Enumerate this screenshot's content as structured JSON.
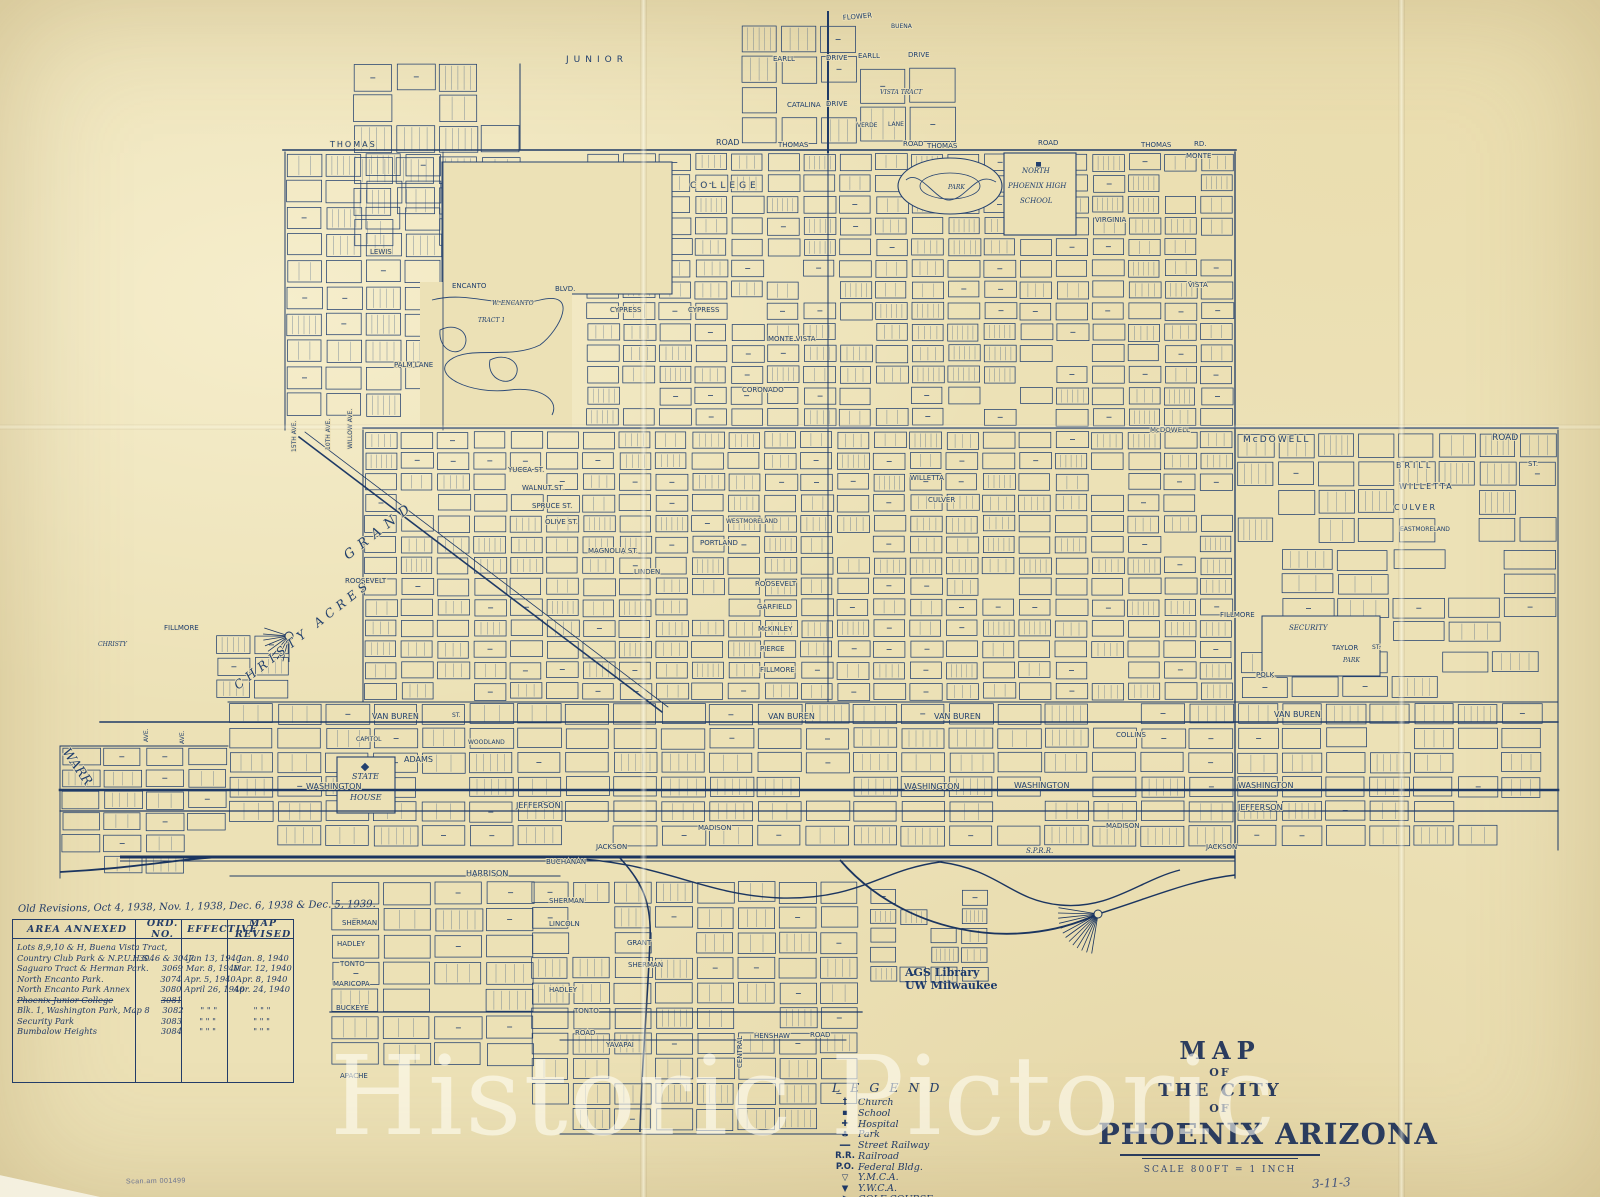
{
  "colors": {
    "ink": "#24416f",
    "paper": "#ece1b6"
  },
  "watermark": "Historic Pictoric",
  "title_block": {
    "map": "MAP",
    "of1": "OF",
    "the_city": "THE CITY",
    "of2": "OF",
    "city": "PHOENIX ARIZONA",
    "scale": "SCALE  800FT = 1 INCH"
  },
  "stamp": {
    "line1": "AGS Library",
    "line2": "UW Milwaukee"
  },
  "annotations": {
    "corner_note": "3-11-3",
    "scan_note": "Scan.am 001499"
  },
  "legend": {
    "title": "L E G E N D",
    "items": [
      {
        "icon": "church-icon",
        "glyph": "†",
        "label": "Church"
      },
      {
        "icon": "school-icon",
        "glyph": "▪",
        "label": "School"
      },
      {
        "icon": "hospital-icon",
        "glyph": "✚",
        "label": "Hospital"
      },
      {
        "icon": "park-icon",
        "glyph": "♣",
        "label": "Park"
      },
      {
        "icon": "street-railway-icon",
        "glyph": "━━",
        "label": "Street Railway"
      },
      {
        "icon": "railroad-icon",
        "glyph": "R.R.",
        "label": "Railroad"
      },
      {
        "icon": "federal-bldg-icon",
        "glyph": "P.O.",
        "label": "Federal Bldg."
      },
      {
        "icon": "ymca-icon",
        "glyph": "▽",
        "label": "Y.M.C.A."
      },
      {
        "icon": "ywca-icon",
        "glyph": "▼",
        "label": "Y.W.C.A."
      },
      {
        "icon": "golf-course-icon",
        "glyph": "⚑",
        "label": "GOLF COURSE"
      }
    ]
  },
  "annex": {
    "note": "Old Revisions, Oct 4, 1938,  Nov. 1, 1938,  Dec. 6, 1938 & Dec. 5, 1939.",
    "headers": [
      "AREA  ANNEXED",
      "ORD. NO.",
      "EFFECTIVE",
      "MAP REVISED"
    ],
    "rows": [
      {
        "area": "Lots 8,9,10 & H, Buena Vista Tract,",
        "ord": "",
        "eff": "",
        "rev": "",
        "struck": false
      },
      {
        "area": "Country Club Park & N.P.U.H.S.",
        "ord": "3046 & 3047",
        "eff": "Jan 13, 1940",
        "rev": "Jan. 8, 1940",
        "struck": false
      },
      {
        "area": "Saguaro Tract & Herman Park.",
        "ord": "3069",
        "eff": "Mar. 8, 1940",
        "rev": "Mar. 12, 1940",
        "struck": false
      },
      {
        "area": "North Encanto Park.",
        "ord": "3074",
        "eff": "Apr. 5, 1940",
        "rev": "Apr. 8, 1940",
        "struck": false
      },
      {
        "area": "North Encanto Park Annex",
        "ord": "3080",
        "eff": "April 26, 1940",
        "rev": "Apr. 24, 1940",
        "struck": false
      },
      {
        "area": "Phoenix Junior College",
        "ord": "3081",
        "eff": "",
        "rev": "",
        "struck": true
      },
      {
        "area": "Blk. 1, Washington Park, Map 8",
        "ord": "3082",
        "eff": "\"   \"   \"",
        "rev": "\"   \"   \"",
        "struck": false
      },
      {
        "area": "Security Park",
        "ord": "3083",
        "eff": "\"   \"   \"",
        "rev": "\"   \"   \"",
        "struck": false
      },
      {
        "area": "Bumbalow Heights",
        "ord": "3084",
        "eff": "\"   \"   \"",
        "rev": "\"   \"   \"",
        "struck": false
      }
    ]
  },
  "map": {
    "labels": [
      {
        "t": "JUNIOR",
        "x": 566,
        "y": 62,
        "s": 9,
        "ls": 5
      },
      {
        "t": "COLLEGE",
        "x": 690,
        "y": 188,
        "s": 9,
        "ls": 4
      },
      {
        "t": "THOMAS",
        "x": 330,
        "y": 147,
        "s": 8,
        "ls": 2
      },
      {
        "t": "ROAD",
        "x": 716,
        "y": 145,
        "s": 8
      },
      {
        "t": "THOMAS",
        "x": 778,
        "y": 147,
        "s": 7
      },
      {
        "t": "ROAD",
        "x": 903,
        "y": 146,
        "s": 7
      },
      {
        "t": "THOMAS",
        "x": 927,
        "y": 148,
        "s": 7
      },
      {
        "t": "ROAD",
        "x": 1038,
        "y": 145,
        "s": 7
      },
      {
        "t": "THOMAS",
        "x": 1141,
        "y": 147,
        "s": 7
      },
      {
        "t": "RD.",
        "x": 1194,
        "y": 146,
        "s": 7
      },
      {
        "t": "FLOWER",
        "x": 843,
        "y": 20,
        "s": 7,
        "r": -5
      },
      {
        "t": "BUENA",
        "x": 891,
        "y": 28,
        "s": 6
      },
      {
        "t": "VISTA TRACT",
        "x": 880,
        "y": 94,
        "s": 6,
        "i": 1
      },
      {
        "t": "EARLL",
        "x": 773,
        "y": 61,
        "s": 7
      },
      {
        "t": "DRIVE",
        "x": 826,
        "y": 60,
        "s": 7
      },
      {
        "t": "EARLL",
        "x": 858,
        "y": 58,
        "s": 7
      },
      {
        "t": "DRIVE",
        "x": 908,
        "y": 57,
        "s": 7
      },
      {
        "t": "CATALINA",
        "x": 787,
        "y": 107,
        "s": 7
      },
      {
        "t": "DRIVE",
        "x": 826,
        "y": 106,
        "s": 7
      },
      {
        "t": "VERDE",
        "x": 857,
        "y": 127,
        "s": 6
      },
      {
        "t": "LANE",
        "x": 888,
        "y": 126,
        "s": 6
      },
      {
        "t": "NORTH",
        "x": 1022,
        "y": 173,
        "s": 7,
        "i": 1
      },
      {
        "t": "PHOENIX HIGH",
        "x": 1008,
        "y": 188,
        "s": 7,
        "i": 1
      },
      {
        "t": "SCHOOL",
        "x": 1020,
        "y": 203,
        "s": 7,
        "i": 1
      },
      {
        "t": "PARK",
        "x": 948,
        "y": 189,
        "s": 6,
        "i": 1
      },
      {
        "t": "MONTE",
        "x": 1186,
        "y": 158,
        "s": 7
      },
      {
        "t": "VIRGINIA",
        "x": 1095,
        "y": 222,
        "s": 7
      },
      {
        "t": "VISTA",
        "x": 1188,
        "y": 287,
        "s": 7
      },
      {
        "t": "ENCANTO",
        "x": 452,
        "y": 288,
        "s": 7
      },
      {
        "t": "BLVD.",
        "x": 555,
        "y": 291,
        "s": 7
      },
      {
        "t": "W. ENCANTO",
        "x": 492,
        "y": 305,
        "s": 6,
        "i": 1
      },
      {
        "t": "TRACT 1",
        "x": 478,
        "y": 322,
        "s": 6,
        "i": 1
      },
      {
        "t": "CYPRESS",
        "x": 610,
        "y": 312,
        "s": 7
      },
      {
        "t": "CYPRESS",
        "x": 688,
        "y": 312,
        "s": 7
      },
      {
        "t": "MONTE VISTA",
        "x": 768,
        "y": 341,
        "s": 7
      },
      {
        "t": "PALM LANE",
        "x": 394,
        "y": 367,
        "s": 7
      },
      {
        "t": "CORONADO",
        "x": 742,
        "y": 392,
        "s": 7
      },
      {
        "t": "LEWIS",
        "x": 370,
        "y": 254,
        "s": 7
      },
      {
        "t": "McDOWELL",
        "x": 1243,
        "y": 442,
        "s": 9,
        "ls": 2
      },
      {
        "t": "ROAD",
        "x": 1492,
        "y": 440,
        "s": 9
      },
      {
        "t": "McDOWELL",
        "x": 1150,
        "y": 432,
        "s": 7
      },
      {
        "t": "BRILL",
        "x": 1396,
        "y": 468,
        "s": 8,
        "ls": 3
      },
      {
        "t": "ST.",
        "x": 1528,
        "y": 466,
        "s": 7
      },
      {
        "t": "WILLETTA",
        "x": 1399,
        "y": 489,
        "s": 8,
        "ls": 2
      },
      {
        "t": "CULVER",
        "x": 1394,
        "y": 510,
        "s": 8,
        "ls": 2
      },
      {
        "t": "EASTMORELAND",
        "x": 1400,
        "y": 531,
        "s": 6
      },
      {
        "t": "WILLETTA",
        "x": 910,
        "y": 480,
        "s": 7
      },
      {
        "t": "CULVER",
        "x": 928,
        "y": 502,
        "s": 7
      },
      {
        "t": "YUCCA ST.",
        "x": 508,
        "y": 472,
        "s": 7
      },
      {
        "t": "WALNUT ST.",
        "x": 522,
        "y": 490,
        "s": 7
      },
      {
        "t": "SPRUCE ST.",
        "x": 532,
        "y": 508,
        "s": 7
      },
      {
        "t": "OLIVE ST.",
        "x": 545,
        "y": 524,
        "s": 7
      },
      {
        "t": "MAGNOLIA ST.",
        "x": 588,
        "y": 553,
        "s": 7
      },
      {
        "t": "LINDEN",
        "x": 634,
        "y": 574,
        "s": 7
      },
      {
        "t": "PORTLAND",
        "x": 700,
        "y": 545,
        "s": 7
      },
      {
        "t": "WESTMORELAND",
        "x": 726,
        "y": 523,
        "s": 6
      },
      {
        "t": "ROOSEVELT",
        "x": 345,
        "y": 583,
        "s": 7
      },
      {
        "t": "ROOSEVELT",
        "x": 755,
        "y": 586,
        "s": 7
      },
      {
        "t": "GARFIELD",
        "x": 757,
        "y": 609,
        "s": 7
      },
      {
        "t": "McKINLEY",
        "x": 758,
        "y": 631,
        "s": 7
      },
      {
        "t": "PIERCE",
        "x": 760,
        "y": 651,
        "s": 7
      },
      {
        "t": "FILLMORE",
        "x": 760,
        "y": 672,
        "s": 7
      },
      {
        "t": "GRAND",
        "x": 348,
        "y": 560,
        "r": -38,
        "s": 13,
        "ls": 7,
        "i": 1
      },
      {
        "t": "CHRISTY  ACRES",
        "x": 238,
        "y": 690,
        "r": -38,
        "s": 12,
        "ls": 5,
        "i": 1
      },
      {
        "t": "CHRISTY",
        "x": 98,
        "y": 646,
        "s": 6,
        "i": 1
      },
      {
        "t": "FILLMORE",
        "x": 164,
        "y": 630,
        "s": 7
      },
      {
        "t": "FILLMORE",
        "x": 1220,
        "y": 617,
        "s": 7
      },
      {
        "t": "SECURITY",
        "x": 1289,
        "y": 630,
        "s": 7,
        "i": 1
      },
      {
        "t": "TAYLOR",
        "x": 1332,
        "y": 650,
        "s": 7
      },
      {
        "t": "ST.",
        "x": 1372,
        "y": 649,
        "s": 6
      },
      {
        "t": "PARK",
        "x": 1343,
        "y": 662,
        "s": 6,
        "i": 1
      },
      {
        "t": "POLK",
        "x": 1256,
        "y": 677,
        "s": 7
      },
      {
        "t": "VAN BUREN",
        "x": 372,
        "y": 719,
        "s": 8
      },
      {
        "t": "ST.",
        "x": 452,
        "y": 717,
        "s": 6
      },
      {
        "t": "VAN BUREN",
        "x": 768,
        "y": 719,
        "s": 8
      },
      {
        "t": "VAN BUREN",
        "x": 934,
        "y": 719,
        "s": 8
      },
      {
        "t": "VAN BUREN",
        "x": 1274,
        "y": 717,
        "s": 8
      },
      {
        "t": "COLLINS",
        "x": 1116,
        "y": 737,
        "s": 7
      },
      {
        "t": "WOODLAND",
        "x": 468,
        "y": 744,
        "s": 6
      },
      {
        "t": "CAPITOL",
        "x": 356,
        "y": 741,
        "s": 6
      },
      {
        "t": "ADAMS",
        "x": 404,
        "y": 762,
        "s": 8
      },
      {
        "t": "STATE",
        "x": 352,
        "y": 779,
        "s": 8,
        "i": 1
      },
      {
        "t": "HOUSE",
        "x": 350,
        "y": 800,
        "s": 8,
        "i": 1
      },
      {
        "t": "WASHINGTON",
        "x": 306,
        "y": 789,
        "s": 8
      },
      {
        "t": "WASHINGTON",
        "x": 904,
        "y": 789,
        "s": 8
      },
      {
        "t": "WASHINGTON",
        "x": 1014,
        "y": 788,
        "s": 8
      },
      {
        "t": "WASHINGTON",
        "x": 1238,
        "y": 788,
        "s": 8
      },
      {
        "t": "JEFFERSON",
        "x": 516,
        "y": 808,
        "s": 8
      },
      {
        "t": "JEFFERSON",
        "x": 1238,
        "y": 810,
        "s": 8
      },
      {
        "t": "MADISON",
        "x": 698,
        "y": 830,
        "s": 7
      },
      {
        "t": "MADISON",
        "x": 1106,
        "y": 828,
        "s": 7
      },
      {
        "t": "JACKSON",
        "x": 596,
        "y": 849,
        "s": 7
      },
      {
        "t": "JACKSON",
        "x": 1206,
        "y": 849,
        "s": 7
      },
      {
        "t": "HARRISON",
        "x": 466,
        "y": 876,
        "s": 8
      },
      {
        "t": "S.P.R.R.",
        "x": 1026,
        "y": 853,
        "s": 7,
        "i": 1
      },
      {
        "t": "BUCHANAN",
        "x": 546,
        "y": 864,
        "s": 7
      },
      {
        "t": "SHERMAN",
        "x": 549,
        "y": 903,
        "s": 7
      },
      {
        "t": "LINCOLN",
        "x": 549,
        "y": 926,
        "s": 7
      },
      {
        "t": "GRANT",
        "x": 627,
        "y": 945,
        "s": 7
      },
      {
        "t": "SHERMAN",
        "x": 628,
        "y": 967,
        "s": 7
      },
      {
        "t": "HADLEY",
        "x": 549,
        "y": 992,
        "s": 7
      },
      {
        "t": "TONTO",
        "x": 574,
        "y": 1013,
        "s": 7
      },
      {
        "t": "SHERMAN",
        "x": 342,
        "y": 925,
        "s": 7
      },
      {
        "t": "HADLEY",
        "x": 337,
        "y": 946,
        "s": 7
      },
      {
        "t": "TONTO",
        "x": 340,
        "y": 966,
        "s": 7
      },
      {
        "t": "MARICOPA",
        "x": 333,
        "y": 986,
        "s": 7
      },
      {
        "t": "BUCKEYE",
        "x": 336,
        "y": 1010,
        "s": 7
      },
      {
        "t": "APACHE",
        "x": 340,
        "y": 1078,
        "s": 7
      },
      {
        "t": "ROAD",
        "x": 575,
        "y": 1035,
        "s": 7
      },
      {
        "t": "HENSHAW",
        "x": 754,
        "y": 1038,
        "s": 7
      },
      {
        "t": "ROAD",
        "x": 810,
        "y": 1037,
        "s": 7
      },
      {
        "t": "YAVAPAI",
        "x": 606,
        "y": 1047,
        "s": 7
      },
      {
        "t": "CENTRAL",
        "x": 742,
        "y": 1068,
        "r": -90,
        "s": 7
      },
      {
        "t": "WARR",
        "x": 62,
        "y": 752,
        "r": 55,
        "s": 13,
        "i": 1
      },
      {
        "t": "15TH AVE.",
        "x": 296,
        "y": 452,
        "r": -90,
        "s": 6
      },
      {
        "t": "10TH AVE.",
        "x": 330,
        "y": 450,
        "r": -90,
        "s": 6
      },
      {
        "t": "WILLOW AVE.",
        "x": 352,
        "y": 449,
        "r": -90,
        "s": 6
      },
      {
        "t": "AVE.",
        "x": 148,
        "y": 742,
        "r": -90,
        "s": 6
      },
      {
        "t": "AVE.",
        "x": 184,
        "y": 744,
        "r": -90,
        "s": 6
      }
    ]
  }
}
